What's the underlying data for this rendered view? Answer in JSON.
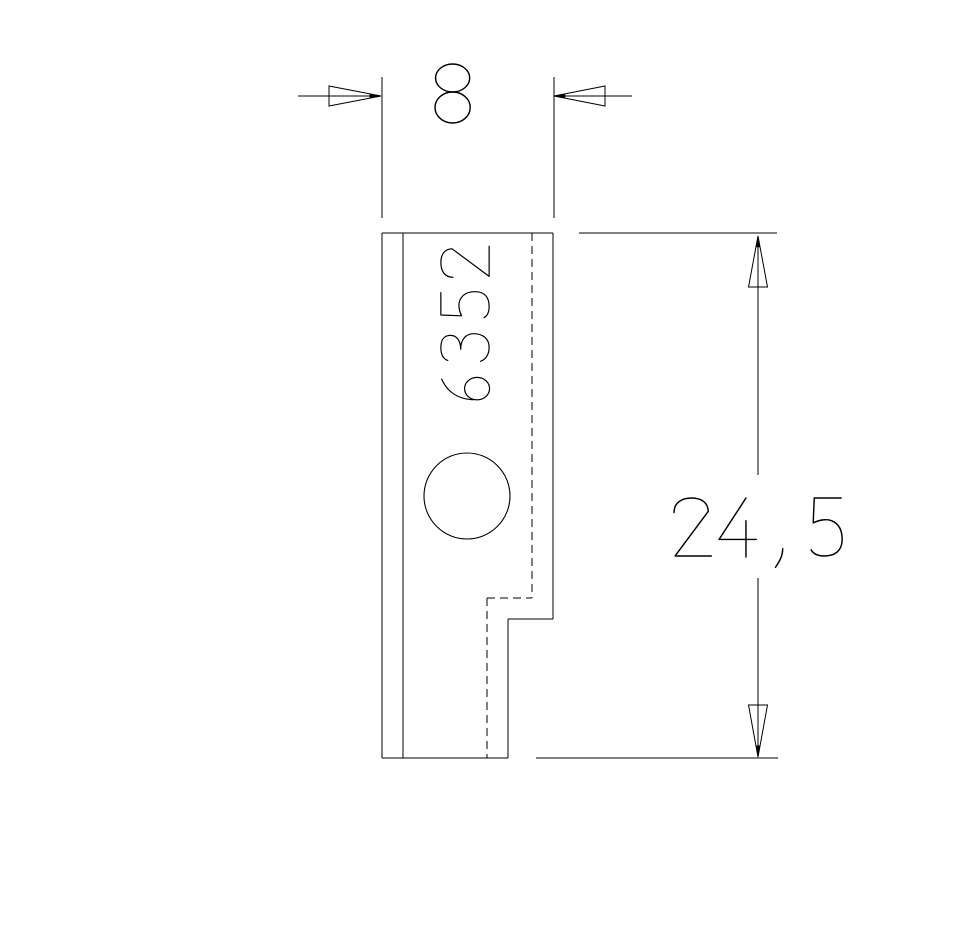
{
  "drawing": {
    "background": "#ffffff",
    "line_color": "#000000",
    "part": {
      "stamp_number": "6352",
      "outline_solid_lines": [
        [
          382,
          233,
          553,
          233
        ],
        [
          382,
          233,
          382,
          758
        ],
        [
          403,
          233,
          403,
          758
        ],
        [
          553,
          233,
          553,
          619
        ],
        [
          508,
          619,
          553,
          619
        ],
        [
          508,
          619,
          508,
          758
        ],
        [
          382,
          758,
          508,
          758
        ]
      ],
      "hidden_dashed_lines": [
        [
          532,
          233,
          532,
          598
        ],
        [
          487,
          598,
          532,
          598
        ],
        [
          487,
          598,
          487,
          758
        ]
      ],
      "hole": {
        "cx": 467,
        "cy": 496,
        "r": 43
      },
      "stamp_text": {
        "text": "6352",
        "x": 440,
        "y": 405,
        "cap": 50,
        "advance": 42,
        "rotate": -90
      }
    },
    "dimensions": {
      "width": {
        "value": "8",
        "extension_lines": [
          [
            382,
            77,
            382,
            218
          ],
          [
            554,
            77,
            554,
            218
          ]
        ],
        "leader_lines": [
          [
            298,
            96,
            381,
            96
          ],
          [
            554,
            96,
            632,
            96
          ]
        ],
        "arrows": [
          {
            "tip": [
              381,
              96
            ],
            "base": [
              [
                329,
                86
              ],
              [
                329,
                106
              ]
            ]
          },
          {
            "tip": [
              554,
              96
            ],
            "base": [
              [
                605,
                86
              ],
              [
                605,
                106
              ]
            ]
          }
        ],
        "text": {
          "x": 434,
          "baseline": 123,
          "cap": 60,
          "advance": 45
        }
      },
      "height": {
        "value": "24,5",
        "extension_lines": [
          [
            579,
            233,
            777,
            233
          ],
          [
            536,
            758,
            778,
            758
          ]
        ],
        "dim_line_segments": [
          [
            758,
            236,
            758,
            475
          ],
          [
            758,
            578,
            758,
            756
          ]
        ],
        "arrows": [
          {
            "tip": [
              758,
              236
            ],
            "base": [
              [
                748.5,
                287
              ],
              [
                767.5,
                287
              ]
            ]
          },
          {
            "tip": [
              758,
              757
            ],
            "base": [
              [
                748.5,
                705
              ],
              [
                767.5,
                705
              ]
            ]
          }
        ],
        "text": {
          "x": 672,
          "baseline": 557,
          "cap": 60,
          "advance": 45
        }
      }
    }
  }
}
